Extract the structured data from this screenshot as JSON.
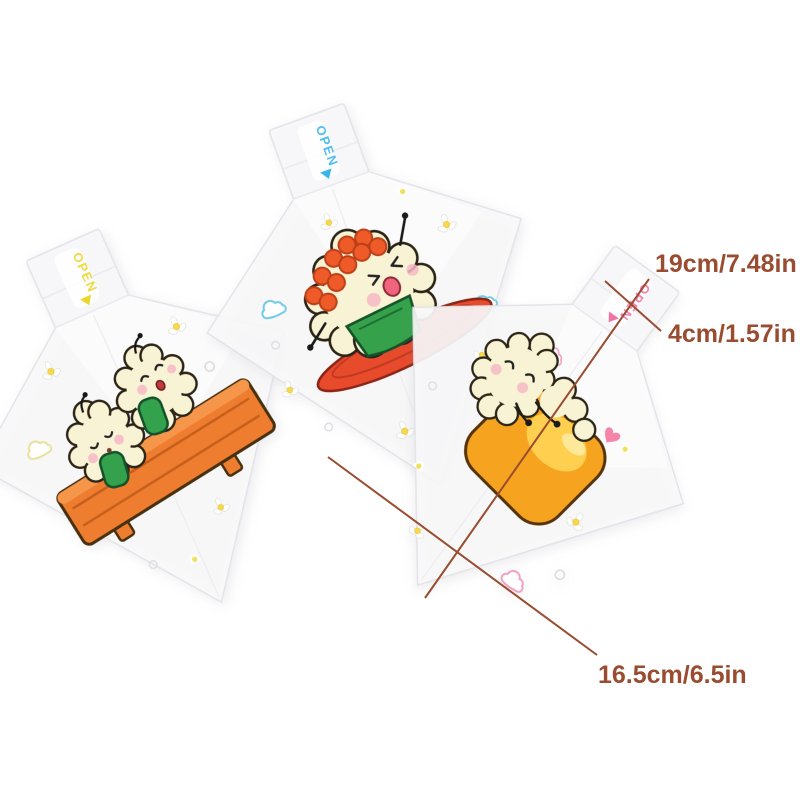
{
  "image_type": "product-photo-with-dimension-annotations",
  "background": "#ffffff",
  "annotations": {
    "color": "#9a4c30",
    "measurements": [
      {
        "name": "bag-length",
        "label": "19cm/7.48in"
      },
      {
        "name": "flap-width",
        "label": "4cm/1.57in"
      },
      {
        "name": "bag-width",
        "label": "16.5cm/6.5in"
      }
    ]
  },
  "bags": [
    {
      "name": "left-bag",
      "open_label": "OPEN",
      "open_color": "#ead629",
      "design": "two smiling rice balls with green nori bands lying on an orange wooden bench"
    },
    {
      "name": "middle-bag",
      "open_label": "OPEN",
      "open_color": "#3ab5e9",
      "design": "rice ball topped with orange salmon roe sitting on a red plate"
    },
    {
      "name": "right-bag",
      "open_label": "OPEN",
      "open_color": "#f273a3",
      "design": "sleeping rice ball hugging a yellow tamago pillow"
    }
  ],
  "decor_colors": {
    "daisy_center": "#f6da4c",
    "cloud_left": "#e9e09a",
    "cloud_middle": "#6fc9ea",
    "cloud_right": "#f2a0c2",
    "heart": "#f585a8"
  }
}
